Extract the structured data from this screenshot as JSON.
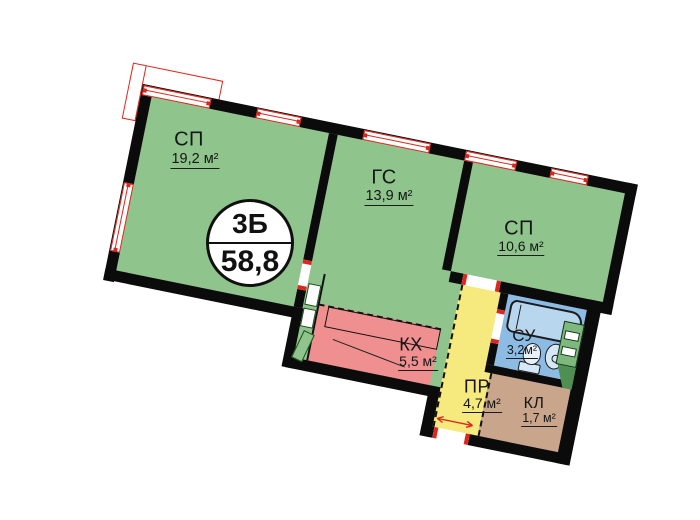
{
  "badge": {
    "type_label": "3Б",
    "total_area": "58,8"
  },
  "rooms": [
    {
      "id": "sp1",
      "name": "СП",
      "area": "19,2 м²"
    },
    {
      "id": "gs",
      "name": "ГС",
      "area": "13,9 м²"
    },
    {
      "id": "sp2",
      "name": "СП",
      "area": "10,6 м²"
    },
    {
      "id": "kx",
      "name": "КХ",
      "area": "5,5 м²"
    },
    {
      "id": "pr",
      "name": "ПР",
      "area": "4,7 м²"
    },
    {
      "id": "su",
      "name": "СУ",
      "area": "3,2м²"
    },
    {
      "id": "kl",
      "name": "КЛ",
      "area": "1,7 м²"
    }
  ],
  "palette": {
    "room_green": "#8fc48c",
    "kitchen_pink": "#ef8f8f",
    "hall_yellow": "#f6e97e",
    "bath_blue": "#8cbce4",
    "closet_tan": "#c9a58c",
    "marking_red": "#e0251c",
    "wall_black": "#0b0b0b"
  }
}
